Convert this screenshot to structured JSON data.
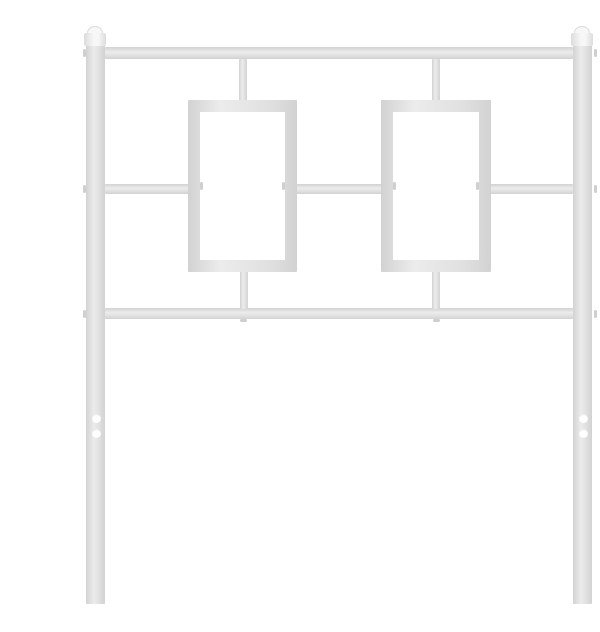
{
  "scene": {
    "type": "product-photo",
    "description": "White metal bed headboard on a plain white background: two square vertical posts topped with square finial caps, three horizontal rails, two rectangular tube frames centered between the top and bottom rails joined by short vertical connector stubs, and legs with two round mounting holes each",
    "object": "white metal headboard",
    "background_color": "#ffffff"
  },
  "colors": {
    "bg": "#ffffff",
    "metal-base": "#e0e0e0",
    "metal-hi": "#ececec",
    "metal-edge": "#d2d2d2",
    "finial": "#f7f7f7",
    "finial-edge": "#dcdcdc",
    "weld": "#cfcfcf"
  },
  "parts": {
    "posts": 2,
    "finials": 2,
    "rails": 3,
    "rectangle_frames": 2,
    "connector_stubs": 4,
    "mounting_holes_per_leg": 2,
    "material_finish": "white powder-coated metal"
  }
}
